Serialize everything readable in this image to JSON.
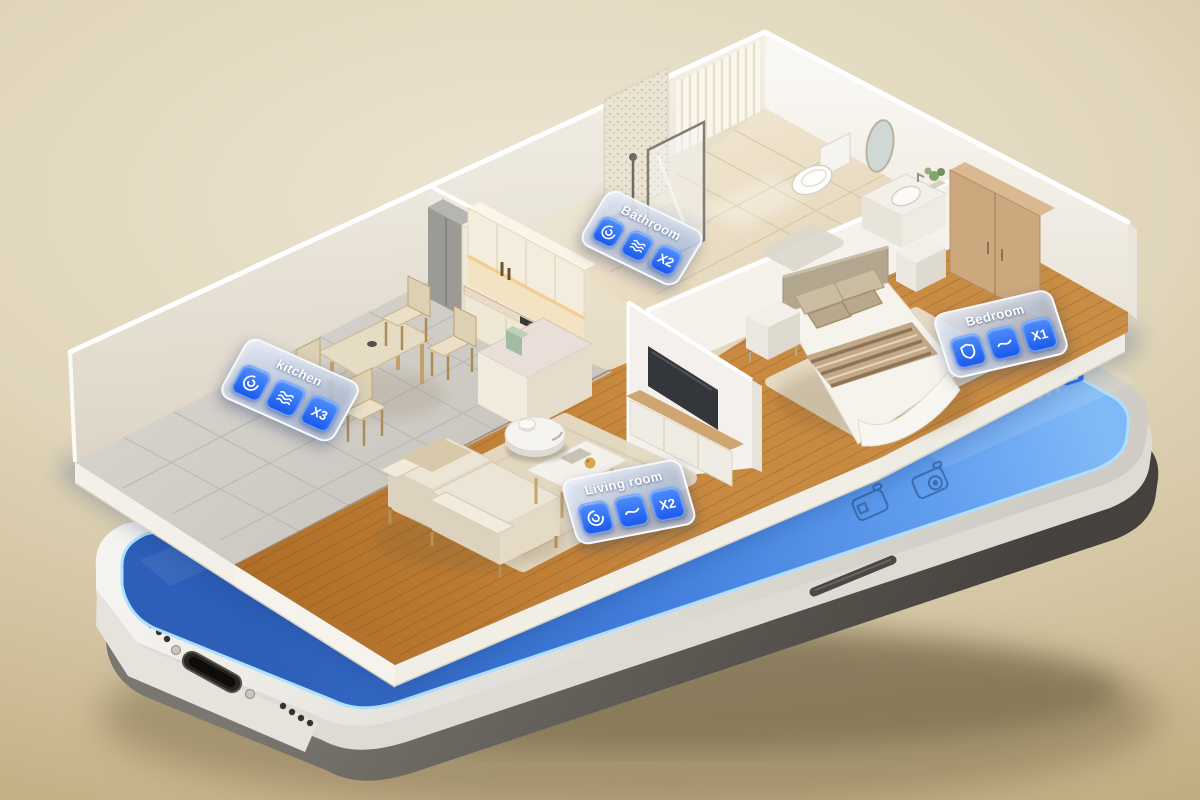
{
  "room_labels": {
    "kitchen": {
      "title": "kitchen",
      "count": "X3",
      "icons": [
        "cyclone-icon",
        "waves-icon"
      ]
    },
    "bathroom": {
      "title": "Bathroom",
      "count": "X2",
      "icons": [
        "cyclone-icon",
        "waves-icon"
      ]
    },
    "bedroom": {
      "title": "Bedroom",
      "count": "X1",
      "icons": [
        "shield-icon",
        "curve-icon"
      ]
    },
    "living_room": {
      "title": "Living room",
      "count": "X2",
      "icons": [
        "cyclone-icon",
        "curve-icon"
      ]
    }
  },
  "phone": {
    "screen_icons": [
      "vacuum-station-icon",
      "mop-station-icon",
      "status-app-icon"
    ],
    "screen_color": "#3f7ddd",
    "frame_color": "#efede8"
  },
  "palette": {
    "accent_blue": "#1c5aeb",
    "background_top": "#ece5d2",
    "background_bottom": "#bca878",
    "wall_white": "#f3efe6",
    "wood_floor": "#c8893f",
    "tile_gray": "#d4d1ca",
    "bath_tile": "#ecdfc8"
  }
}
